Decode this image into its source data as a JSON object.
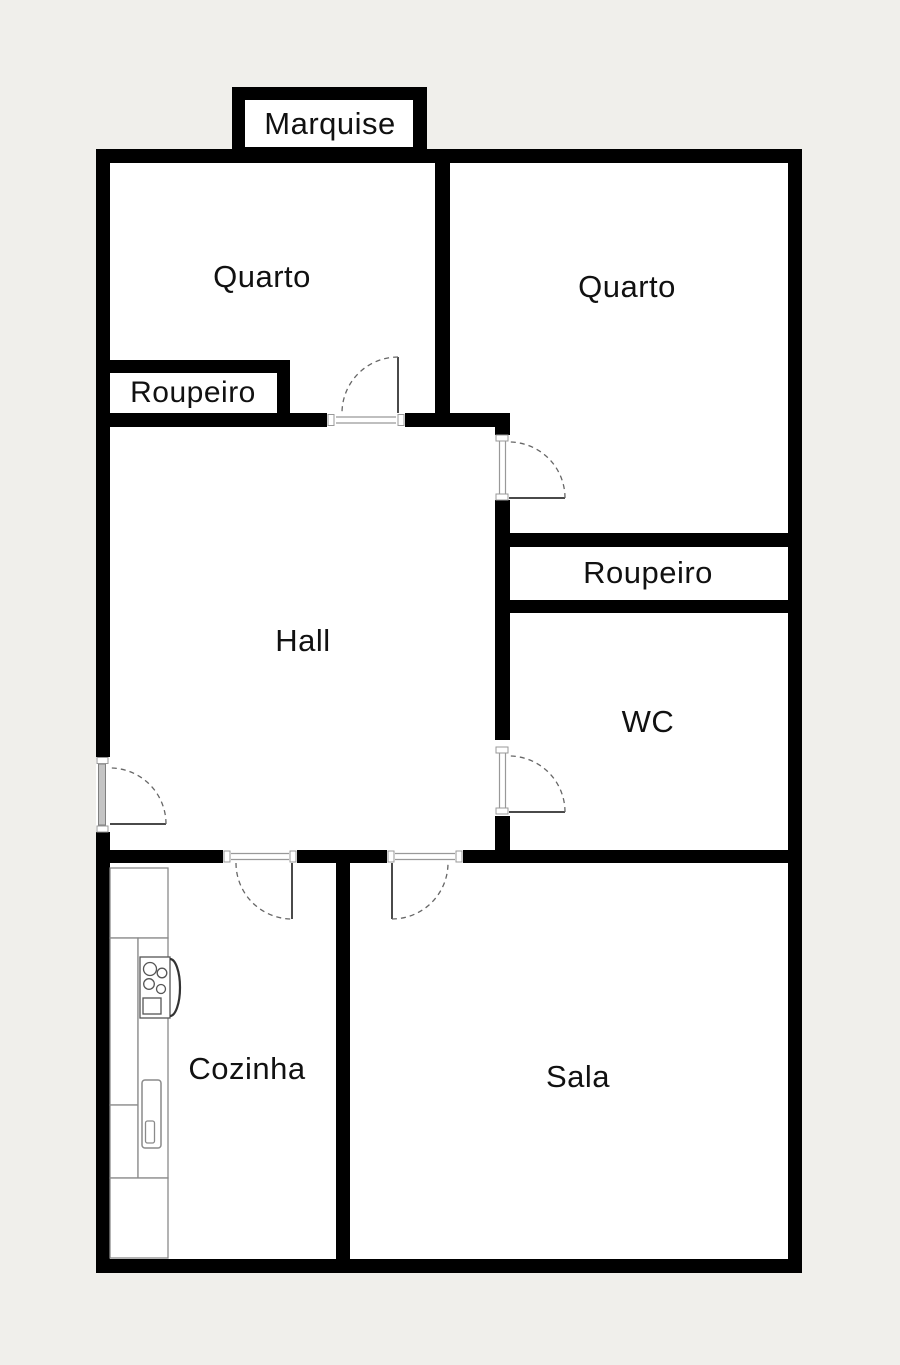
{
  "plan": {
    "labels": {
      "marquise": "Marquise",
      "quarto_left": "Quarto",
      "quarto_right": "Quarto",
      "roupeiro_left": "Roupeiro",
      "roupeiro_right": "Roupeiro",
      "hall": "Hall",
      "wc": "WC",
      "cozinha": "Cozinha",
      "sala": "Sala"
    },
    "colors": {
      "background": "#f0efeb",
      "wall": "#000000",
      "room_fill": "#ffffff",
      "door_leaf_line": "#4a4a4a",
      "door_arc_line": "#666666",
      "fixture_line": "#8a8a8a"
    }
  }
}
